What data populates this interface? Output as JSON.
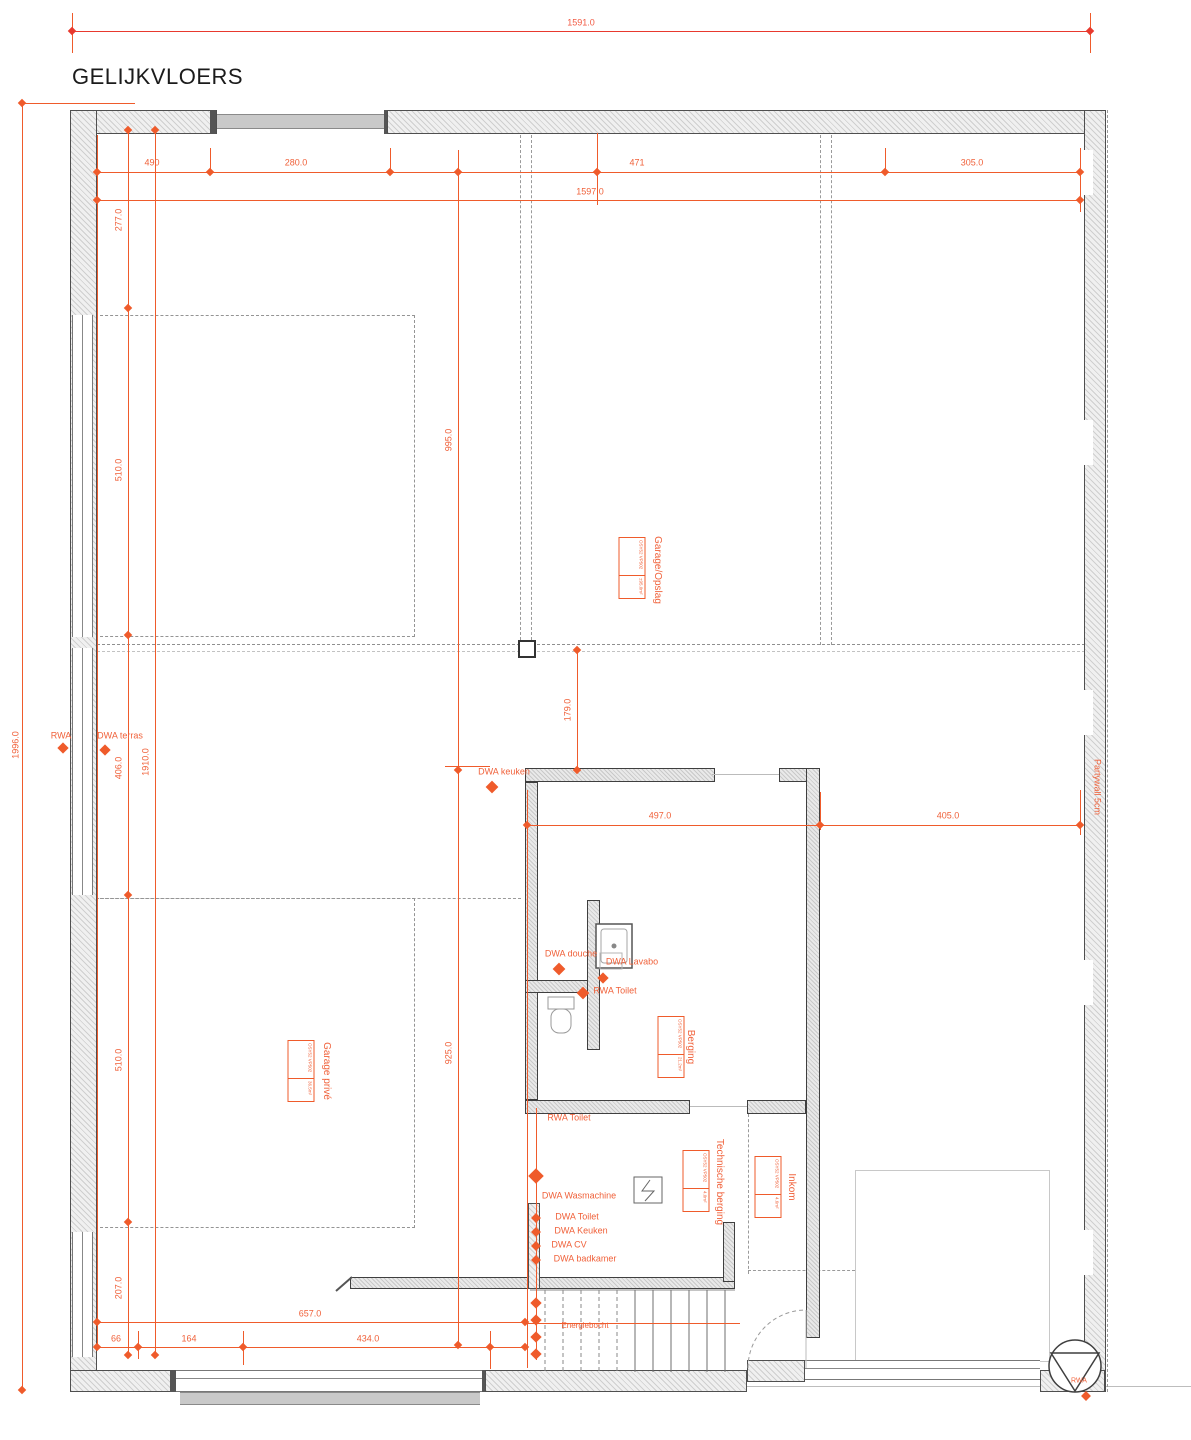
{
  "title": "GELIJKVLOERS",
  "wall_note": "Partywall 5cm",
  "dims": {
    "top_total": "1591.0",
    "seg_490": "490",
    "seg_280": "280.0",
    "seg_471": "471",
    "seg_305": "305.0",
    "top_chain": "1597.0",
    "left_total": "1996.0",
    "left_277": "277.0",
    "left_510a": "510.0",
    "left_406": "406.0",
    "left_510b": "510.0",
    "left_207": "207.0",
    "left_1910": "1910.0",
    "mid_995": "995.0",
    "mid_925": "925.0",
    "mid_179": "179.0",
    "mid_497": "497.0",
    "mid_405": "405.0",
    "bottom_657": "657.0",
    "bottom_66": "66",
    "bottom_164": "164",
    "bottom_434": "434.0"
  },
  "rooms": {
    "garage_opslag": "Garage/Opslag",
    "garage_prive": "Garage privé",
    "berging": "Berging",
    "technische_berging": "Technische berging",
    "inkom": "Inkom"
  },
  "plumbing": {
    "rwa": "RWA",
    "dwa_terras": "DWA terras",
    "dwa_keuken": "DWA keuken",
    "dwa_douche": "DWA douche",
    "dwa_lavabo": "DWA Lavabo",
    "rwa_toilet_1": "RWA Toilet",
    "rwa_toilet_2": "RWA Toilet",
    "dwa_wasmachine": "DWA Wasmachine",
    "dwa_toilet": "DWA Toilet",
    "dwa_keuken_2": "DWA Keuken",
    "dwa_cv": "DWA CV",
    "dwa_badkamer": "DWA badkamer",
    "rwa_corner": "RWA",
    "energiebocht": "Energiebocht"
  },
  "tags": {
    "garage_opslag": {
      "code": "OSY52 VP502",
      "area": "±95.0m²"
    },
    "garage_prive": {
      "code": "OSY52 VP502",
      "area": "36.5m²"
    },
    "berging": {
      "code": "OSY52 VP502",
      "area": "21.2m²"
    },
    "technische_berging": {
      "code": "OSY52 VP502",
      "area": "4.0m²"
    },
    "inkom": {
      "code": "OSY52 VP502",
      "area": "4.6m²"
    }
  },
  "colors": {
    "dimension": "#ef5b2b",
    "wall_dark": "#4f4f4f",
    "door_fill": "#c9c9c9"
  }
}
